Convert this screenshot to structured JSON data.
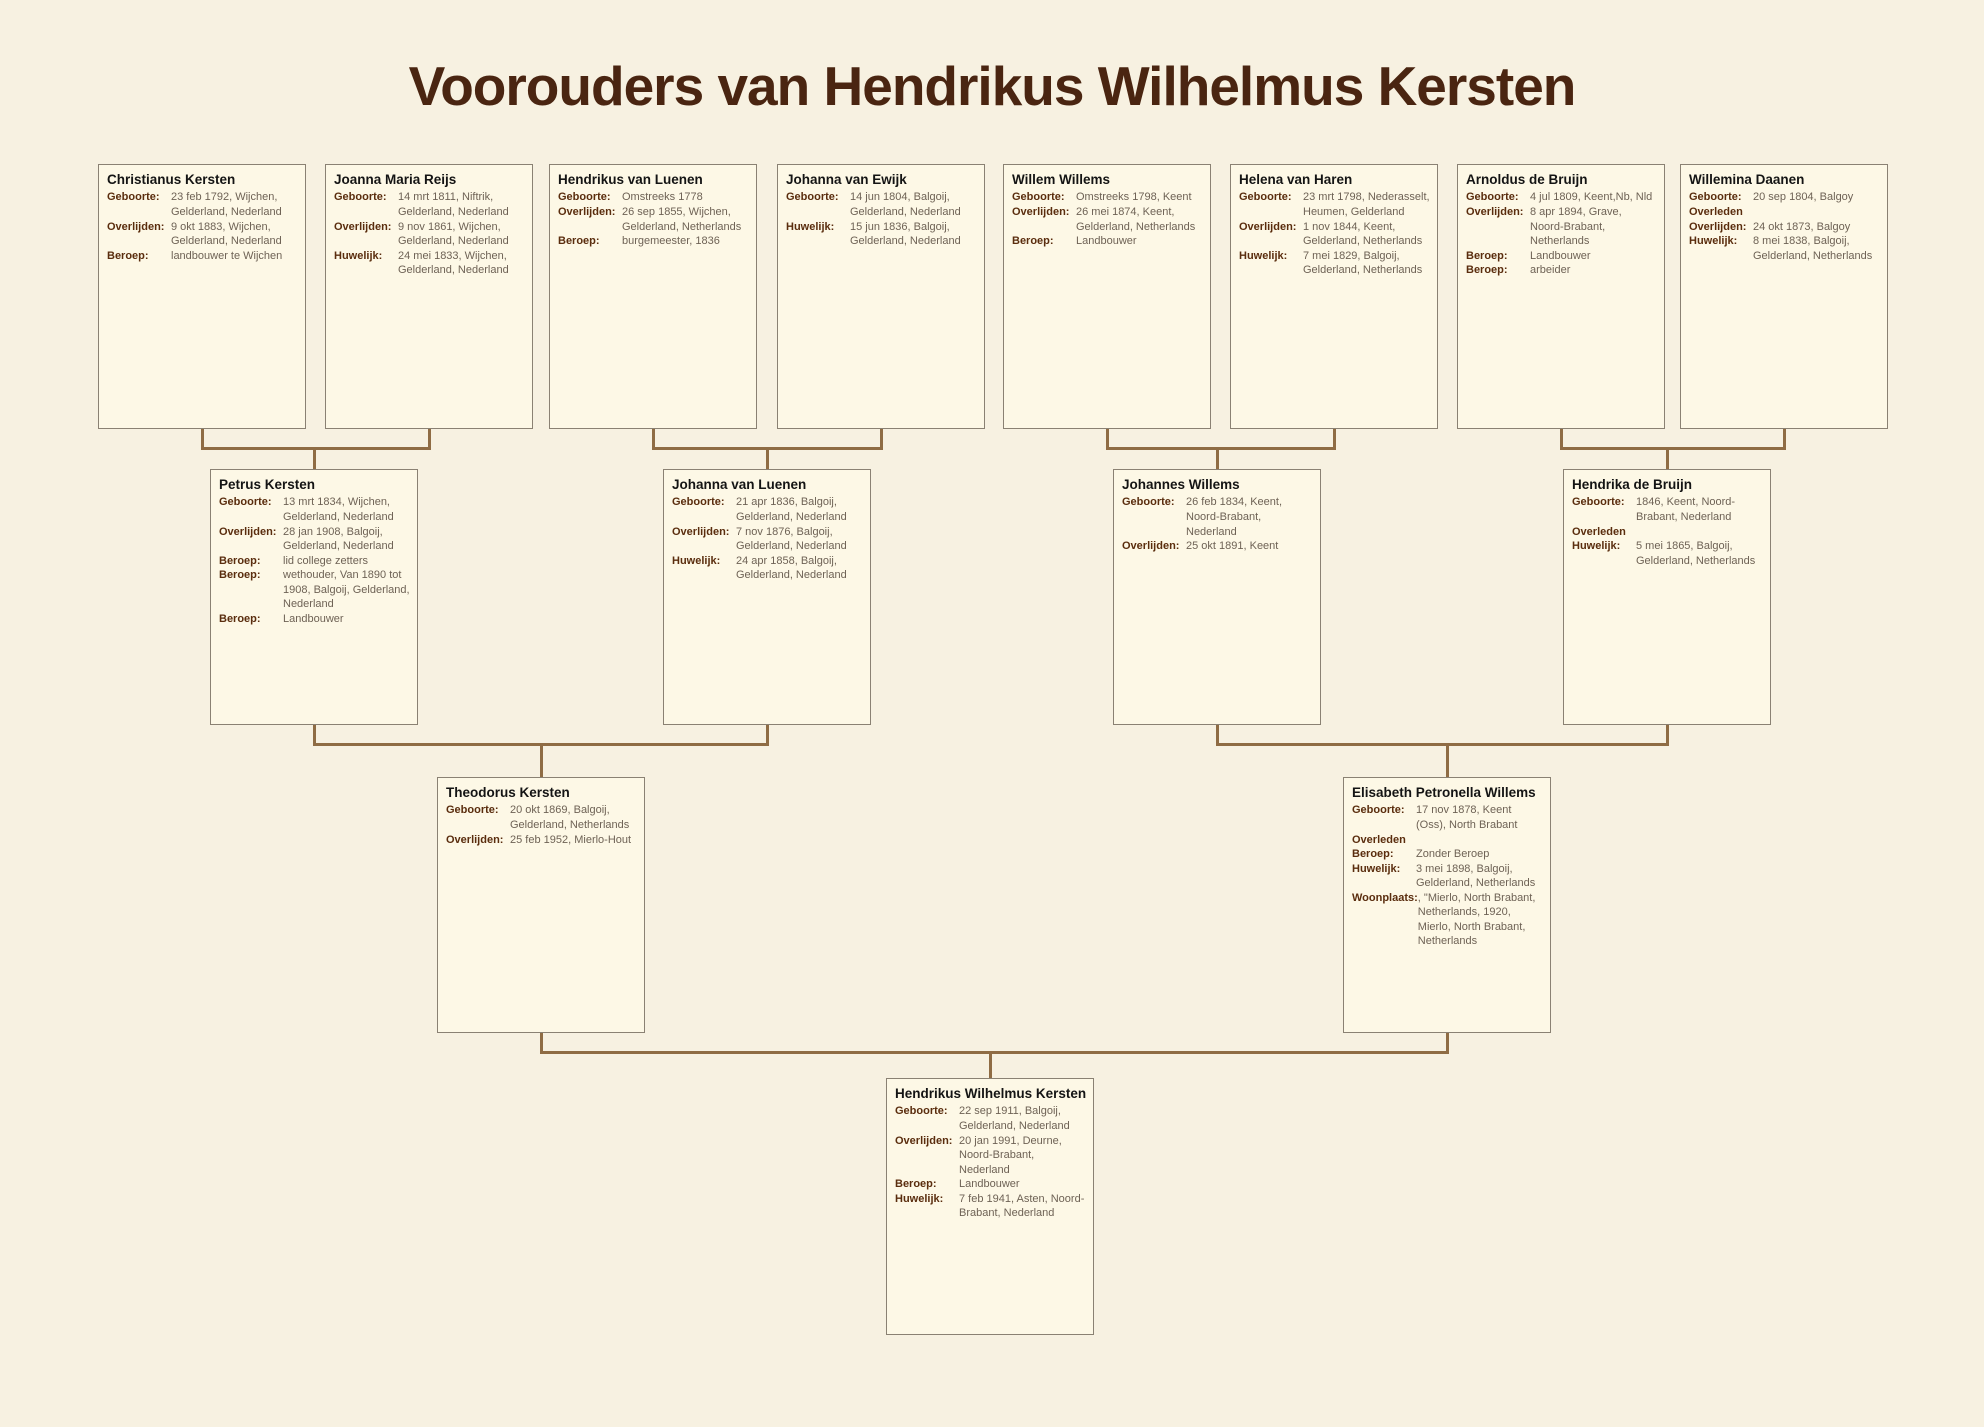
{
  "title": "Voorouders van Hendrikus Wilhelmus Kersten",
  "colors": {
    "page_background": "#f7f1e1",
    "box_background": "#fdf8e6",
    "box_border": "#8a8173",
    "name_text": "#141414",
    "label_text": "#5a2d0e",
    "value_text": "#6e6255",
    "connector": "#8f6c44",
    "title_text": "#4a2511"
  },
  "people": [
    {
      "id": "christianus-kersten",
      "name": "Christianus Kersten",
      "fields": [
        {
          "label": "Geboorte:",
          "value": "23 feb 1792, Wijchen, Gelderland, Nederland"
        },
        {
          "label": "Overlijden:",
          "value": "9 okt 1883, Wijchen, Gelderland, Nederland"
        },
        {
          "label": "Beroep:",
          "value": "landbouwer te Wijchen"
        }
      ]
    },
    {
      "id": "joanna-maria-reijs",
      "name": "Joanna Maria Reijs",
      "fields": [
        {
          "label": "Geboorte:",
          "value": "14 mrt 1811, Niftrik, Gelderland, Nederland"
        },
        {
          "label": "Overlijden:",
          "value": "9 nov 1861, Wijchen, Gelderland, Nederland"
        },
        {
          "label": "Huwelijk:",
          "value": "24 mei 1833, Wijchen, Gelderland, Nederland"
        }
      ]
    },
    {
      "id": "hendrikus-van-luenen",
      "name": "Hendrikus van Luenen",
      "fields": [
        {
          "label": "Geboorte:",
          "value": "Omstreeks 1778"
        },
        {
          "label": "Overlijden:",
          "value": "26 sep 1855, Wijchen, Gelderland, Netherlands"
        },
        {
          "label": "Beroep:",
          "value": "burgemeester, 1836"
        }
      ]
    },
    {
      "id": "johanna-van-ewijk",
      "name": "Johanna van Ewijk",
      "fields": [
        {
          "label": "Geboorte:",
          "value": "14 jun 1804, Balgoij, Gelderland, Nederland"
        },
        {
          "label": "Huwelijk:",
          "value": "15 jun 1836, Balgoij, Gelderland, Nederland"
        }
      ]
    },
    {
      "id": "willem-willems",
      "name": "Willem Willems",
      "fields": [
        {
          "label": "Geboorte:",
          "value": "Omstreeks 1798, Keent"
        },
        {
          "label": "Overlijden:",
          "value": "26 mei 1874, Keent, Gelderland, Netherlands"
        },
        {
          "label": "Beroep:",
          "value": "Landbouwer"
        }
      ]
    },
    {
      "id": "helena-van-haren",
      "name": "Helena van Haren",
      "fields": [
        {
          "label": "Geboorte:",
          "value": "23 mrt 1798, Nederasselt, Heumen, Gelderland"
        },
        {
          "label": "Overlijden:",
          "value": "1 nov 1844, Keent, Gelderland, Netherlands"
        },
        {
          "label": "Huwelijk:",
          "value": "7 mei 1829, Balgoij, Gelderland, Netherlands"
        }
      ]
    },
    {
      "id": "arnoldus-de-bruijn",
      "name": "Arnoldus de Bruijn",
      "fields": [
        {
          "label": "Geboorte:",
          "value": "4 jul 1809, Keent,Nb, Nld"
        },
        {
          "label": "Overlijden:",
          "value": "8 apr 1894, Grave, Noord-Brabant, Netherlands"
        },
        {
          "label": "Beroep:",
          "value": "Landbouwer"
        },
        {
          "label": "Beroep:",
          "value": "arbeider"
        }
      ]
    },
    {
      "id": "willemina-daanen",
      "name": "Willemina Daanen",
      "fields": [
        {
          "label": "Geboorte:",
          "value": "20 sep 1804, Balgoy"
        },
        {
          "label": "Overleden",
          "value": ""
        },
        {
          "label": "Overlijden:",
          "value": "24 okt 1873, Balgoy"
        },
        {
          "label": "Huwelijk:",
          "value": "8 mei 1838, Balgoij, Gelderland, Netherlands"
        }
      ]
    },
    {
      "id": "petrus-kersten",
      "name": "Petrus Kersten",
      "fields": [
        {
          "label": "Geboorte:",
          "value": "13 mrt 1834, Wijchen, Gelderland, Nederland"
        },
        {
          "label": "Overlijden:",
          "value": "28 jan 1908, Balgoij, Gelderland, Nederland"
        },
        {
          "label": "Beroep:",
          "value": "lid college zetters"
        },
        {
          "label": "Beroep:",
          "value": "wethouder, Van 1890 tot 1908, Balgoij, Gelderland, Nederland"
        },
        {
          "label": "Beroep:",
          "value": "Landbouwer"
        }
      ]
    },
    {
      "id": "johanna-van-luenen",
      "name": "Johanna van Luenen",
      "fields": [
        {
          "label": "Geboorte:",
          "value": "21 apr 1836, Balgoij, Gelderland, Nederland"
        },
        {
          "label": "Overlijden:",
          "value": "7 nov 1876, Balgoij, Gelderland, Nederland"
        },
        {
          "label": "Huwelijk:",
          "value": "24 apr 1858, Balgoij, Gelderland, Nederland"
        }
      ]
    },
    {
      "id": "johannes-willems",
      "name": "Johannes Willems",
      "fields": [
        {
          "label": "Geboorte:",
          "value": "26 feb 1834, Keent, Noord-Brabant, Nederland"
        },
        {
          "label": "Overlijden:",
          "value": "25 okt 1891, Keent"
        }
      ]
    },
    {
      "id": "hendrika-de-bruijn",
      "name": "Hendrika de Bruijn",
      "fields": [
        {
          "label": "Geboorte:",
          "value": "1846, Keent, Noord-Brabant, Nederland"
        },
        {
          "label": "Overleden",
          "value": ""
        },
        {
          "label": "Huwelijk:",
          "value": "5 mei 1865, Balgoij, Gelderland, Netherlands"
        }
      ]
    },
    {
      "id": "theodorus-kersten",
      "name": "Theodorus Kersten",
      "fields": [
        {
          "label": "Geboorte:",
          "value": "20 okt 1869, Balgoij, Gelderland, Netherlands"
        },
        {
          "label": "Overlijden:",
          "value": "25 feb 1952, Mierlo-Hout"
        }
      ]
    },
    {
      "id": "elisabeth-petronella-willems",
      "name": "Elisabeth Petronella Willems",
      "fields": [
        {
          "label": "Geboorte:",
          "value": "17 nov 1878, Keent (Oss), North Brabant"
        },
        {
          "label": "Overleden",
          "value": ""
        },
        {
          "label": "Beroep:",
          "value": "Zonder Beroep"
        },
        {
          "label": "Huwelijk:",
          "value": "3 mei 1898, Balgoij, Gelderland, Netherlands"
        },
        {
          "label": "Woonplaats:",
          "value": ", \"Mierlo, North Brabant, Netherlands, 1920, Mierlo, North Brabant, Netherlands"
        }
      ]
    },
    {
      "id": "hendrikus-wilhelmus-kersten",
      "name": "Hendrikus Wilhelmus Kersten",
      "fields": [
        {
          "label": "Geboorte:",
          "value": "22 sep 1911, Balgoij, Gelderland, Nederland"
        },
        {
          "label": "Overlijden:",
          "value": "20 jan 1991, Deurne, Noord-Brabant, Nederland"
        },
        {
          "label": "Beroep:",
          "value": "Landbouwer"
        },
        {
          "label": "Huwelijk:",
          "value": "7 feb 1941, Asten, Noord-Brabant, Nederland"
        }
      ]
    }
  ],
  "families": [
    {
      "parents": [
        "christianus-kersten",
        "joanna-maria-reijs"
      ],
      "child": "petrus-kersten"
    },
    {
      "parents": [
        "hendrikus-van-luenen",
        "johanna-van-ewijk"
      ],
      "child": "johanna-van-luenen"
    },
    {
      "parents": [
        "willem-willems",
        "helena-van-haren"
      ],
      "child": "johannes-willems"
    },
    {
      "parents": [
        "arnoldus-de-bruijn",
        "willemina-daanen"
      ],
      "child": "hendrika-de-bruijn"
    },
    {
      "parents": [
        "petrus-kersten",
        "johanna-van-luenen"
      ],
      "child": "theodorus-kersten"
    },
    {
      "parents": [
        "johannes-willems",
        "hendrika-de-bruijn"
      ],
      "child": "elisabeth-petronella-willems"
    },
    {
      "parents": [
        "theodorus-kersten",
        "elisabeth-petronella-willems"
      ],
      "child": "hendrikus-wilhelmus-kersten"
    }
  ]
}
